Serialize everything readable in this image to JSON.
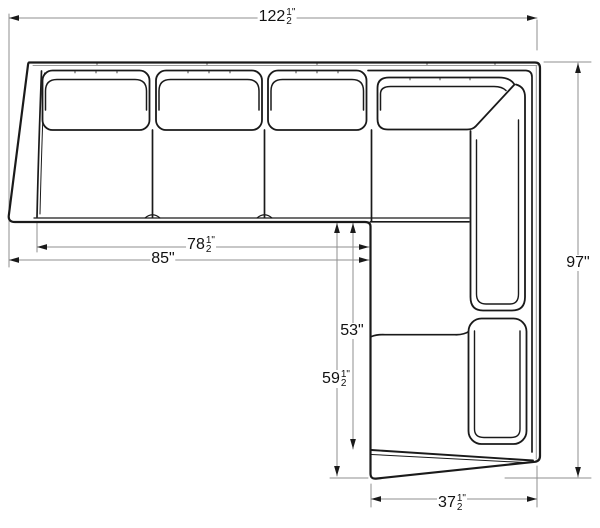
{
  "diagram": {
    "subject": "sectional-sofa-with-chaise-top-view",
    "line_color": "#1a1a1a",
    "dimension_line_color": "#8f8f8f",
    "background": "#ffffff"
  },
  "dimensions": {
    "total_width": {
      "whole": "122",
      "num": "1",
      "den": "2",
      "unit": "\"",
      "inches": 122.5
    },
    "interior_width": {
      "whole": "78",
      "num": "1",
      "den": "2",
      "unit": "\"",
      "inches": 78.5
    },
    "left_section_width": {
      "whole": "85",
      "unit": "\"",
      "inches": 85
    },
    "chaise_interior_length": {
      "whole": "53",
      "unit": "\"",
      "inches": 53
    },
    "chaise_length": {
      "whole": "59",
      "num": "1",
      "den": "2",
      "unit": "\"",
      "inches": 59.5
    },
    "total_depth": {
      "whole": "97",
      "unit": "\"",
      "inches": 97
    },
    "chaise_width": {
      "whole": "37",
      "num": "1",
      "den": "2",
      "unit": "\"",
      "inches": 37.5
    }
  }
}
